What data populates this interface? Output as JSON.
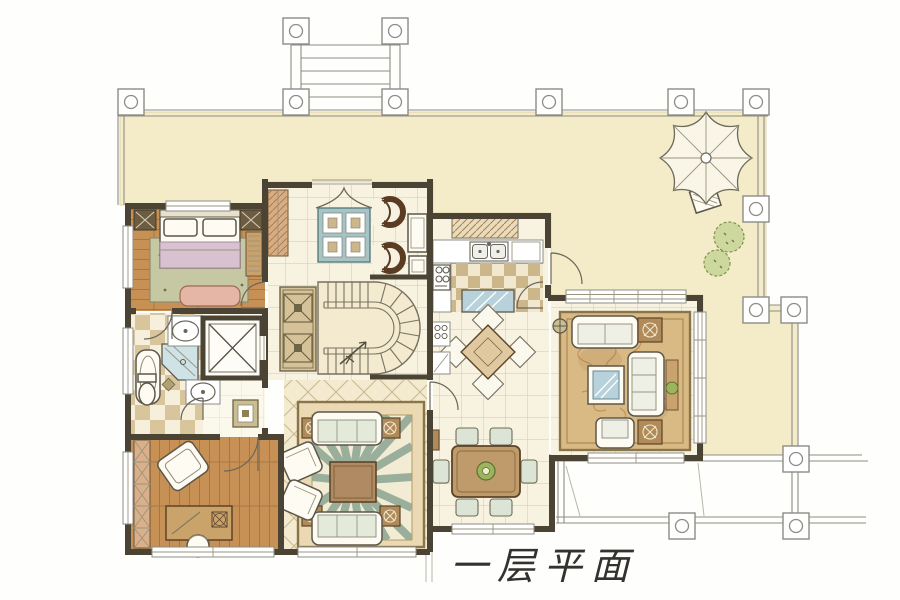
{
  "title": {
    "text": "一层平面"
  },
  "palette": {
    "paper": "#fefefd",
    "terrace": "#f4ebc8",
    "terrace_line": "#8d8d85",
    "wall": "#4b4435",
    "wood": "#c79155",
    "wood_line": "#9f7038",
    "tile": "#f8f3e1",
    "tile_line": "#d5caa6",
    "checker": "#d9c59c",
    "checker_bg": "#f6efdc",
    "lattice_line": "#cbb88f",
    "rug_field": "#d9ba85",
    "rug_border": "#8a7449",
    "sage": "#8fa895",
    "teal": "#a4c4c6",
    "blue_glass": "#b7d2da",
    "pink": "#e5b6a6",
    "lavender": "#d8c2cf",
    "plant": "#9cb45e",
    "shrub": "#cdd89e",
    "furn_brown": "#b08a58",
    "dark_wood": "#5d4428",
    "ink": "#33322e"
  }
}
